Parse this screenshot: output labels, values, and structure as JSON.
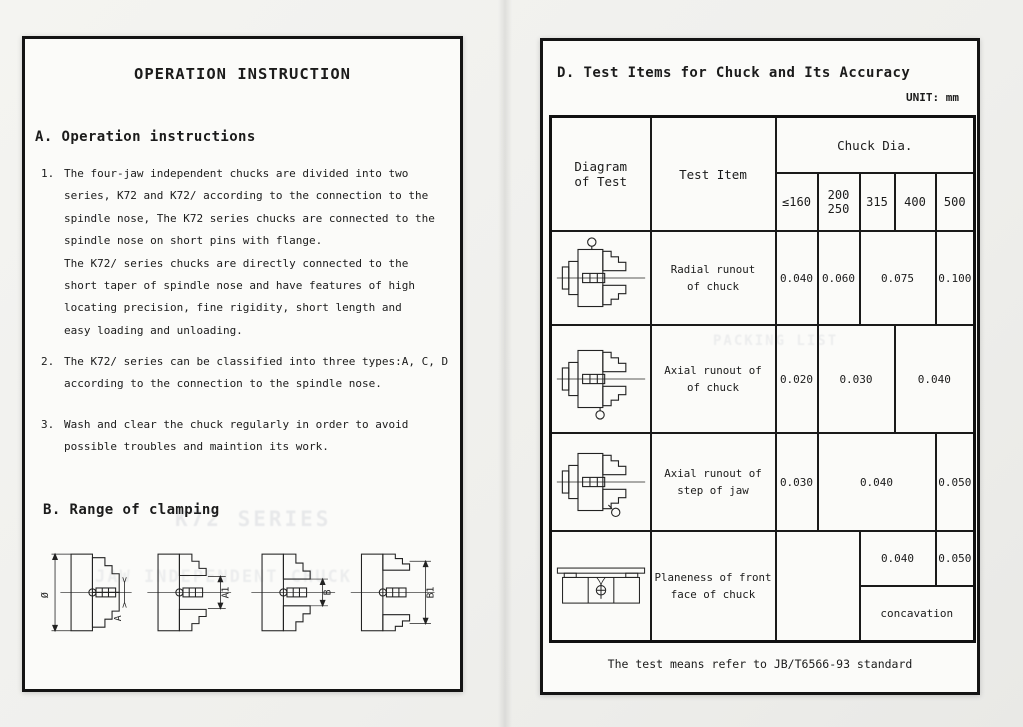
{
  "left_page": {
    "title": "OPERATION INSTRUCTION",
    "section_a": {
      "heading": "A. Operation instructions",
      "items": [
        {
          "num": "1.",
          "text": "The four-jaw independent chucks are divided into two\nseries, K72 and K72/ according to the connection to the\nspindle nose, The K72 series chucks are connected to the\nspindle nose on short pins with flange.\nThe K72/ series chucks are directly connected to the\nshort taper of spindle nose and have features of high\nlocating precision, fine rigidity,  short length and\neasy loading and unloading."
        },
        {
          "num": "2.",
          "text": "The K72/ series can be classified into three types:A, C, D\naccording to the connection to the spindle nose."
        },
        {
          "num": "3.",
          "text": "Wash and clear the chuck regularly in order to avoid\npossible troubles and maintion its work."
        }
      ]
    },
    "section_b": {
      "heading": "B. Range of clamping",
      "diagrams": [
        {
          "outer": "Ø",
          "inner": "A"
        },
        {
          "inner": "A1"
        },
        {
          "inner": "B"
        },
        {
          "inner": "B1"
        }
      ]
    },
    "ghosts": [
      "K72 SERIES",
      "JAW INDEPENDENT CHUCK"
    ]
  },
  "right_page": {
    "heading": "D. Test Items for Chuck and Its Accuracy",
    "unit_label": "UNIT: mm",
    "ghosts": [
      "PACKING LIST"
    ],
    "table": {
      "col_diagram": "Diagram\nof Test",
      "col_test_item": "Test Item",
      "chuck_dia": "Chuck Dia.",
      "size_cols": [
        "≤160",
        "200\n250",
        "315",
        "400",
        "500"
      ],
      "rows": [
        {
          "item": "Radial runout\nof chuck",
          "values": [
            {
              "t": "0.040"
            },
            {
              "t": "0.060"
            },
            {
              "t": "0.075"
            },
            {
              "t": "0.100"
            }
          ]
        },
        {
          "item": "Axial runout of\nof chuck",
          "values": [
            {
              "t": "0.020"
            },
            {
              "t": "0.030"
            },
            {
              "t": "0.040"
            }
          ]
        },
        {
          "item": "Axial runout of\nstep of jaw",
          "values": [
            {
              "t": "0.030"
            },
            {
              "t": "0.040"
            },
            {
              "t": "0.050"
            }
          ]
        }
      ],
      "planeness": {
        "item": "Planeness of front\nface of chuck",
        "empty": "",
        "top_values": [
          {
            "t": "0.040"
          },
          {
            "t": "0.050"
          }
        ],
        "bottom": "concavation"
      },
      "footnote": "The test means refer to JB/T6566-93 standard"
    }
  }
}
